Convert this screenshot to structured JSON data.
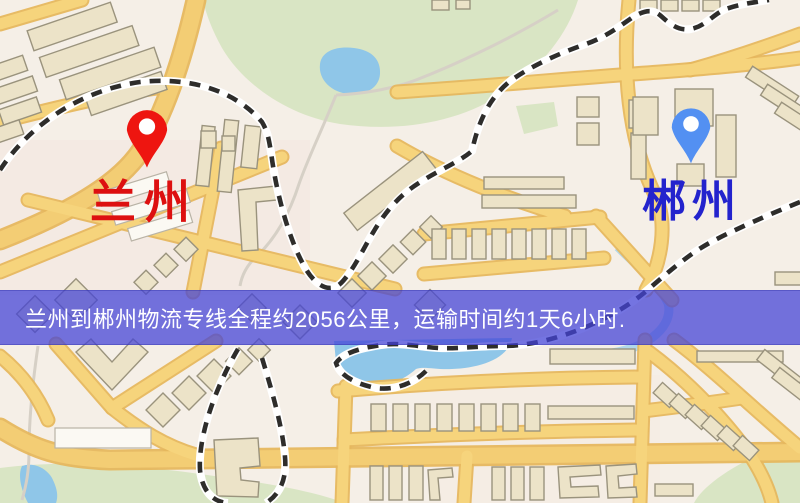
{
  "map": {
    "origin_marker": {
      "label": "兰州",
      "pin_color": "#ee1510",
      "label_color": "#dd1010"
    },
    "destination_marker": {
      "label": "郴州",
      "pin_color": "#5390f2",
      "label_color": "#2323cd"
    },
    "banner": {
      "text": "兰州到郴州物流专线全程约2056公里，运输时间约1天6小时.",
      "background_color": "#4344d6",
      "text_color": "#ffffff",
      "distance_km": "2056",
      "duration": "1天6小时"
    }
  }
}
